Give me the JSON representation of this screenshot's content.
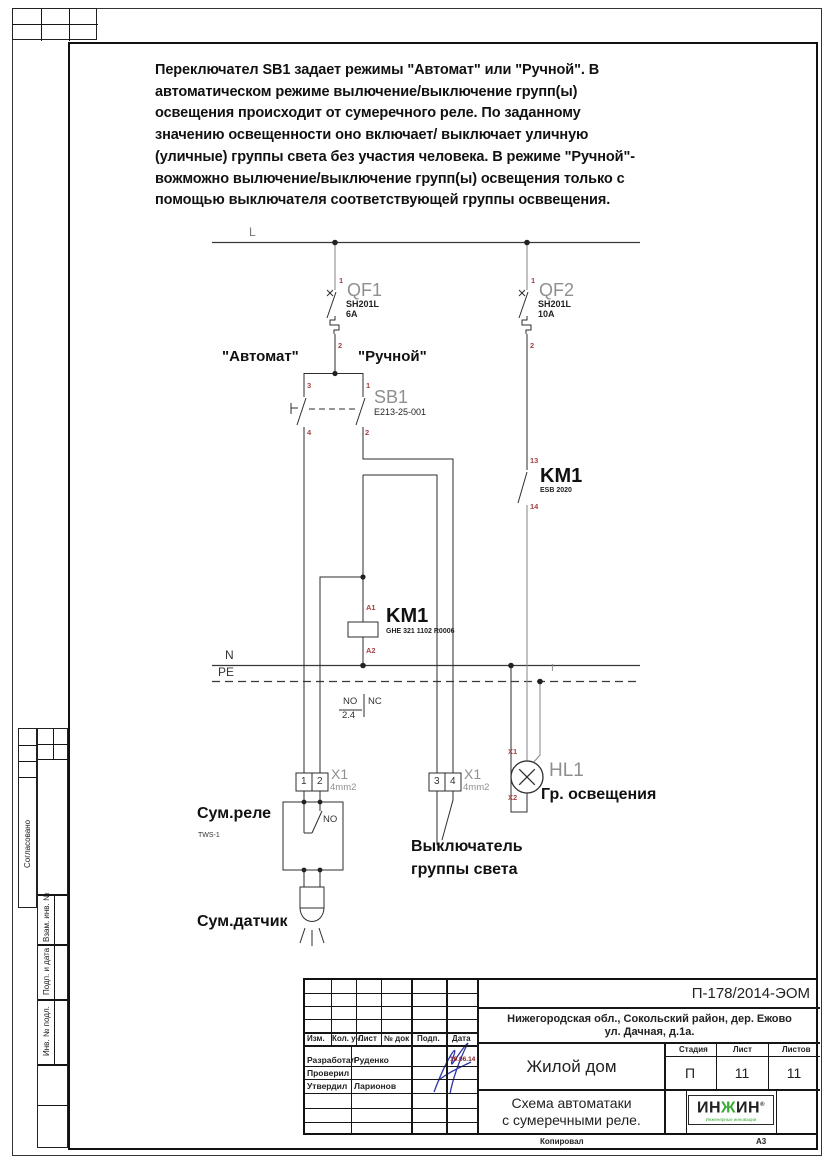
{
  "page": {
    "format": "А3",
    "copied_label": "Копировал"
  },
  "colors": {
    "terminal_red": "#a34343",
    "logo_green": "#3aaa35",
    "signature_blue": "#2d35a8"
  },
  "description": {
    "lines": [
      "Переключател SB1 задает режимы \"Автомат\" или \"Ручной\". В",
      "автоматическом режиме вылючение/выключение групп(ы)",
      "освещения происходит от сумеречного реле. По заданному",
      "значению освещенности оно включает/ выключает уличную",
      "(уличные) группы света без участия человека. В режиме \"Ручной\"-",
      "вожможно вылючение/выключение групп(ы) освещения только с",
      "помощью выключателя соответствующей группы осввещения."
    ]
  },
  "schematic": {
    "bus": {
      "l": "L",
      "n": "N",
      "pe": "PE",
      "i": "I"
    },
    "qf1": {
      "name": "QF1",
      "model": "SH201L",
      "rating": "6A",
      "t_top": "1",
      "t_bottom": "2"
    },
    "qf2": {
      "name": "QF2",
      "model": "SH201L",
      "rating": "10A",
      "t_top": "1",
      "t_bottom": "2"
    },
    "sb1": {
      "name": "SB1",
      "model": "E213-25-001",
      "mode_auto": "\"Автомат\"",
      "mode_manual": "\"Ручной\"",
      "t_auto_top": "3",
      "t_auto_bottom": "4",
      "t_manual_top": "1",
      "t_manual_bottom": "2"
    },
    "km1_contact": {
      "name": "KM1",
      "model": "ESB 2020",
      "t_top": "13",
      "t_bottom": "14"
    },
    "km1_coil": {
      "name": "KM1",
      "model": "GHE 321 1102 R0006",
      "t_top": "A1",
      "t_bottom": "A2"
    },
    "relay_contact_table": {
      "no": "NO",
      "nc": "NC",
      "ref": "2.4"
    },
    "x1_left": {
      "label": "X1",
      "wire": "4mm2",
      "cell1": "1",
      "cell2": "2"
    },
    "x1_right": {
      "label": "X1",
      "wire": "4mm2",
      "cell1": "3",
      "cell2": "4"
    },
    "hl1": {
      "name": "HL1",
      "t_top": "X1",
      "t_bottom": "X2",
      "caption": "Гр. освещения"
    },
    "dusk_relay": {
      "label": "Сум.реле",
      "model": "TWS-1",
      "contact": "NO"
    },
    "dusk_sensor": {
      "label": "Сум.датчик"
    },
    "light_switch": {
      "line1": "Выключатель",
      "line2": "группы света"
    }
  },
  "title_block": {
    "doc_number": "П-178/2014-ЭОМ",
    "address_line1": "Нижегородская обл., Сокольский район, дер. Ежово",
    "address_line2": "ул. Дачная, д.1а.",
    "object_name": "Жилой дом",
    "sheet_name_line1": "Схема автоматаки",
    "sheet_name_line2": "с сумеречными реле.",
    "columns": {
      "izm": "Изм.",
      "kol": "Кол. уч.",
      "list": "Лист",
      "doc": "№ док",
      "podp": "Подп.",
      "date": "Дата"
    },
    "sign_rows": [
      {
        "role": "Разработал",
        "name": "Руденко",
        "date": "10.06.14"
      },
      {
        "role": "Проверил",
        "name": "",
        "date": ""
      },
      {
        "role": "Утвердил",
        "name": "Ларионов",
        "date": ""
      }
    ],
    "stage_label": "Стадия",
    "sheet_label": "Лист",
    "sheets_label": "Листов",
    "stage": "П",
    "sheet": "11",
    "sheets": "11",
    "logo": {
      "part1": "ИН",
      "part2": "Ж",
      "part3": "ИН",
      "reg": "®",
      "tagline": "Инженерные инновации"
    }
  },
  "margin_labels": {
    "approved": "Согласовано",
    "vzam": "Взам. инв. №",
    "podp": "Подп. и дата",
    "inv": "Инв. № подл."
  }
}
